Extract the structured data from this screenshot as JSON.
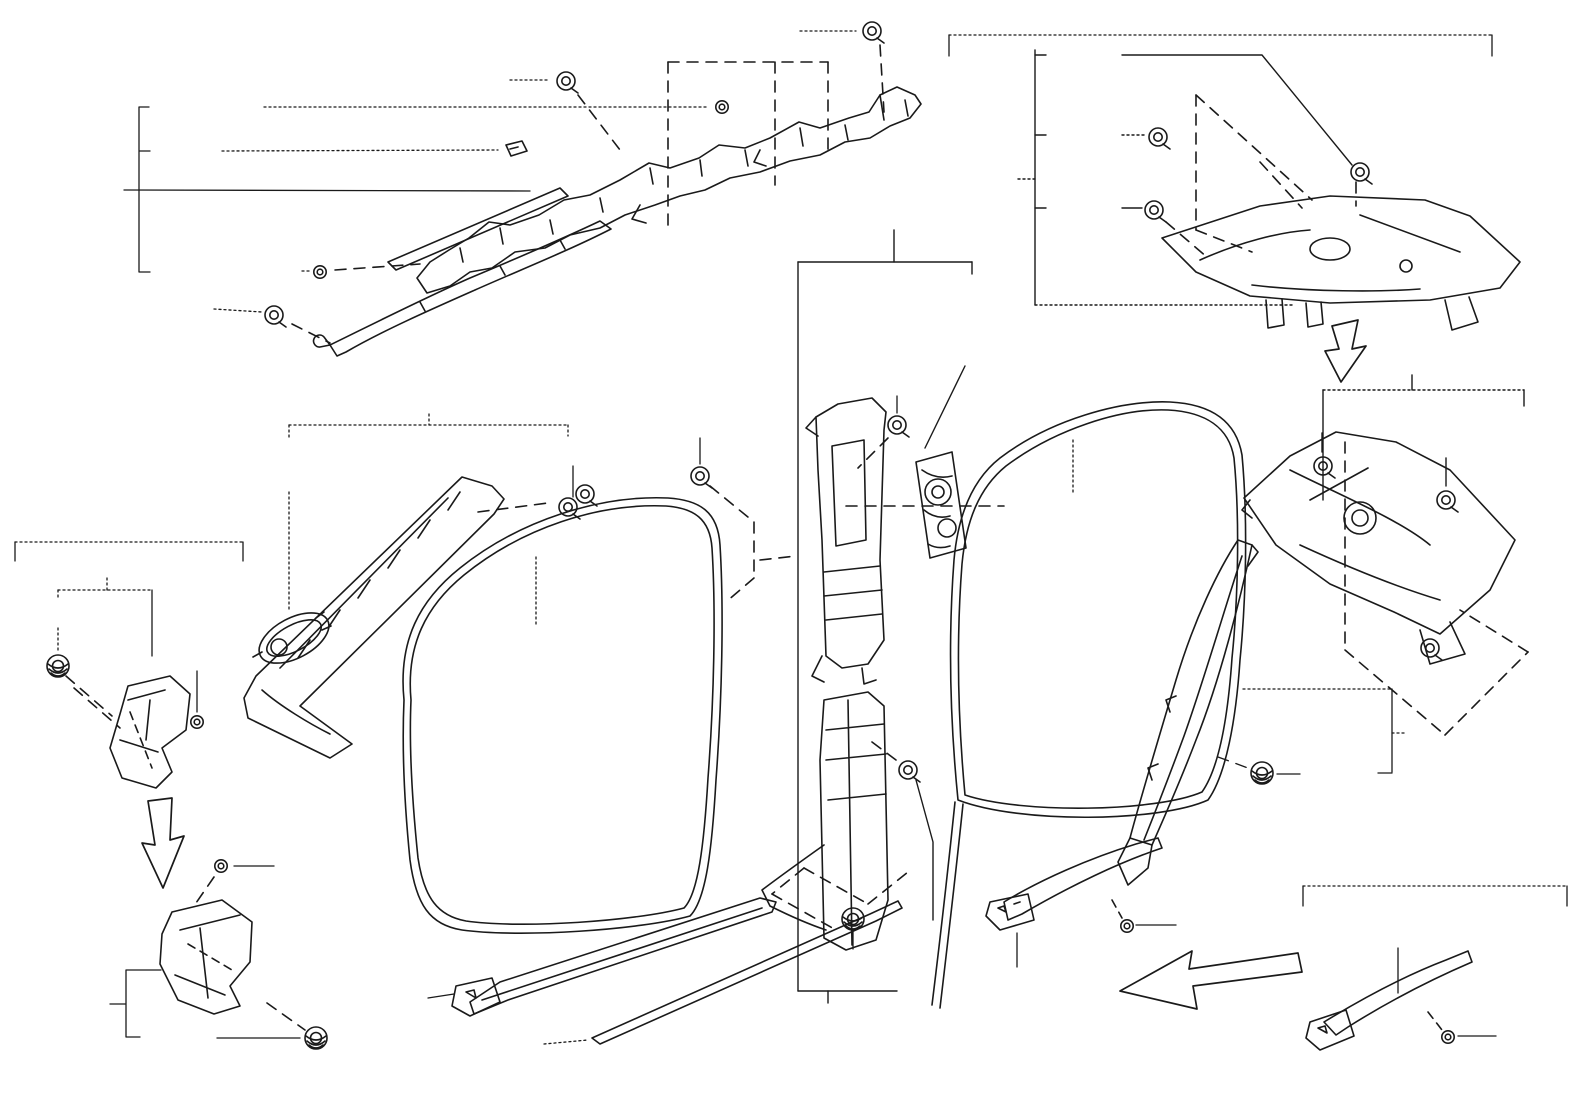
{
  "colors": {
    "line": "#1a1a1a",
    "background": "#ffffff"
  },
  "labels": [
    {
      "id": "note-audio-jbl-jp",
      "text": "※1 有り(オーディオ-JBL)",
      "x": 12,
      "y": 12,
      "v": "n"
    },
    {
      "id": "note-audio-jbl-en",
      "text": "※1 W(AUDIO-JBL)",
      "x": 12,
      "y": 36,
      "v": "n"
    },
    {
      "id": "part-62170b-top",
      "text": "62170B",
      "x": 744,
      "y": 19
    },
    {
      "id": "part-62170b-mid",
      "text": "62170B",
      "x": 444,
      "y": 69
    },
    {
      "id": "part-90467-18017",
      "text": "90467-18017",
      "x": 150,
      "y": 97
    },
    {
      "id": "part-62489a",
      "text": "62489A",
      "x": 152,
      "y": 141
    },
    {
      "id": "part-62170a-rh",
      "text": "62170A(RH)",
      "x": 14,
      "y": 167
    },
    {
      "id": "part-62180a-lh",
      "text": "62180A(LH)",
      "x": 14,
      "y": 190
    },
    {
      "id": "part-90467-18017-2",
      "text": "90467-18017(2)",
      "x": 152,
      "y": 261
    },
    {
      "id": "part-62170b-low",
      "text": "62170B",
      "x": 146,
      "y": 299
    },
    {
      "id": "section-rh-top",
      "text": "RH",
      "x": 944,
      "y": 11,
      "v": "s"
    },
    {
      "id": "part-62638b",
      "text": "62638B",
      "x": 1049,
      "y": 43
    },
    {
      "id": "part-62471g",
      "text": "62471G",
      "x": 1051,
      "y": 122
    },
    {
      "id": "part-62471a",
      "text": "62471A",
      "x": 947,
      "y": 166
    },
    {
      "id": "part-62471j",
      "text": "62471J",
      "x": 1051,
      "y": 196
    },
    {
      "id": "part-62411b-rh",
      "text": "62411B(RH)",
      "x": 855,
      "y": 201
    },
    {
      "id": "part-62412b-lh",
      "text": "62412B(LH)",
      "x": 855,
      "y": 224
    },
    {
      "id": "refer-line-1",
      "text": "REFER TO",
      "x": 928,
      "y": 278,
      "v": "r"
    },
    {
      "id": "refer-line-2",
      "text": "FIG 71-04",
      "x": 928,
      "y": 301,
      "v": "r"
    },
    {
      "id": "refer-line-3",
      "text": "(PNC 73023(RH))",
      "x": 928,
      "y": 324,
      "v": "r"
    },
    {
      "id": "refer-line-4",
      "text": "(PNC 73024(LH))",
      "x": 928,
      "y": 347,
      "v": "r"
    },
    {
      "id": "part-90467-10167",
      "text": "90467-10167",
      "x": 838,
      "y": 372
    },
    {
      "id": "part-62211-rh",
      "text": "62211(RH)",
      "x": 400,
      "y": 366
    },
    {
      "id": "part-62212-lh",
      "text": "62212(LH)",
      "x": 400,
      "y": 389
    },
    {
      "id": "part-90467-10216",
      "text": "90467-10216(4)",
      "x": 636,
      "y": 411
    },
    {
      "id": "part-62217g",
      "text": "62217G",
      "x": 542,
      "y": 440
    },
    {
      "id": "part-62227a-rh",
      "text": "※162227A(RH)",
      "x": 227,
      "y": 442
    },
    {
      "id": "part-62228b-lh",
      "text": "※162228B(LH)",
      "x": 227,
      "y": 466
    },
    {
      "id": "part-62472a",
      "text": "62472A",
      "x": 1390,
      "y": 352
    },
    {
      "id": "part-62471j-2",
      "text": "62471J",
      "x": 1294,
      "y": 409
    },
    {
      "id": "part-62471g-2",
      "text": "62471G",
      "x": 1496,
      "y": 409
    },
    {
      "id": "part-62638b-2",
      "text": "62638B",
      "x": 1418,
      "y": 434
    },
    {
      "id": "part-62331a-rh",
      "text": "62331A(RH)",
      "x": 1041,
      "y": 495
    },
    {
      "id": "part-62332a-lh",
      "text": "62332A(LH)",
      "x": 1041,
      "y": 518
    },
    {
      "id": "section-rh-left",
      "text": "RH",
      "x": 19,
      "y": 521,
      "v": "s"
    },
    {
      "id": "part-62111a",
      "text": "62111A",
      "x": 77,
      "y": 556
    },
    {
      "id": "part-62117c",
      "text": "62117C",
      "x": 28,
      "y": 602
    },
    {
      "id": "part-62117b",
      "text": "62117B",
      "x": 169,
      "y": 648
    },
    {
      "id": "part-62311b-rh",
      "text": "62311B(RH)",
      "x": 508,
      "y": 628
    },
    {
      "id": "part-62312b-lh",
      "text": "62312B(LH)",
      "x": 508,
      "y": 651
    },
    {
      "id": "part-62551f-rh",
      "text": "62551F(RH)",
      "x": 1408,
      "y": 707
    },
    {
      "id": "part-62552f-lh",
      "text": "62552F(LH)",
      "x": 1408,
      "y": 730
    },
    {
      "id": "part-62551e",
      "text": "62551E",
      "x": 1303,
      "y": 765
    },
    {
      "id": "part-62117b-2",
      "text": "62117B",
      "x": 278,
      "y": 856
    },
    {
      "id": "part-67923a-1",
      "text": "67923A",
      "x": 1180,
      "y": 912
    },
    {
      "id": "section-models",
      "text": "MZEH12, ZWE211",
      "x": 1300,
      "y": 864,
      "v": "s"
    },
    {
      "id": "part-67917a-rh-2",
      "text": "67917A(RH)",
      "x": 1367,
      "y": 901
    },
    {
      "id": "part-67918a-lh-2",
      "text": "67918A(LH)",
      "x": 1367,
      "y": 924
    },
    {
      "id": "part-90467-w0005",
      "text": "90467-W0005",
      "x": 878,
      "y": 924
    },
    {
      "id": "part-62413c",
      "text": "62413C",
      "x": 824,
      "y": 951
    },
    {
      "id": "part-67913-rh",
      "text": "67913(RH)",
      "x": 321,
      "y": 977
    },
    {
      "id": "part-67914-lh",
      "text": "67914(LH)",
      "x": 321,
      "y": 1000
    },
    {
      "id": "part-62112a",
      "text": "62112A",
      "x": 38,
      "y": 991
    },
    {
      "id": "part-62117c-2",
      "text": "62117C",
      "x": 143,
      "y": 1026
    },
    {
      "id": "part-67913b-rh",
      "text": "67913B(RH)",
      "x": 422,
      "y": 1025
    },
    {
      "id": "part-67914b-lh",
      "text": "67914B(LH)",
      "x": 422,
      "y": 1048
    },
    {
      "id": "part-62413a-rh",
      "text": "62413A(RH)",
      "x": 800,
      "y": 1005
    },
    {
      "id": "part-62414a-lh",
      "text": "62414A(LH)",
      "x": 800,
      "y": 1028
    },
    {
      "id": "part-67917a-rh-1",
      "text": "67917A(RH)",
      "x": 985,
      "y": 970
    },
    {
      "id": "part-67918a-lh-1",
      "text": "67918A(LH)",
      "x": 985,
      "y": 993
    },
    {
      "id": "part-67923a-2",
      "text": "67923A",
      "x": 1500,
      "y": 1020
    },
    {
      "id": "diagram-code",
      "text": "644489A",
      "x": 1481,
      "y": 1055,
      "v": "s"
    }
  ]
}
